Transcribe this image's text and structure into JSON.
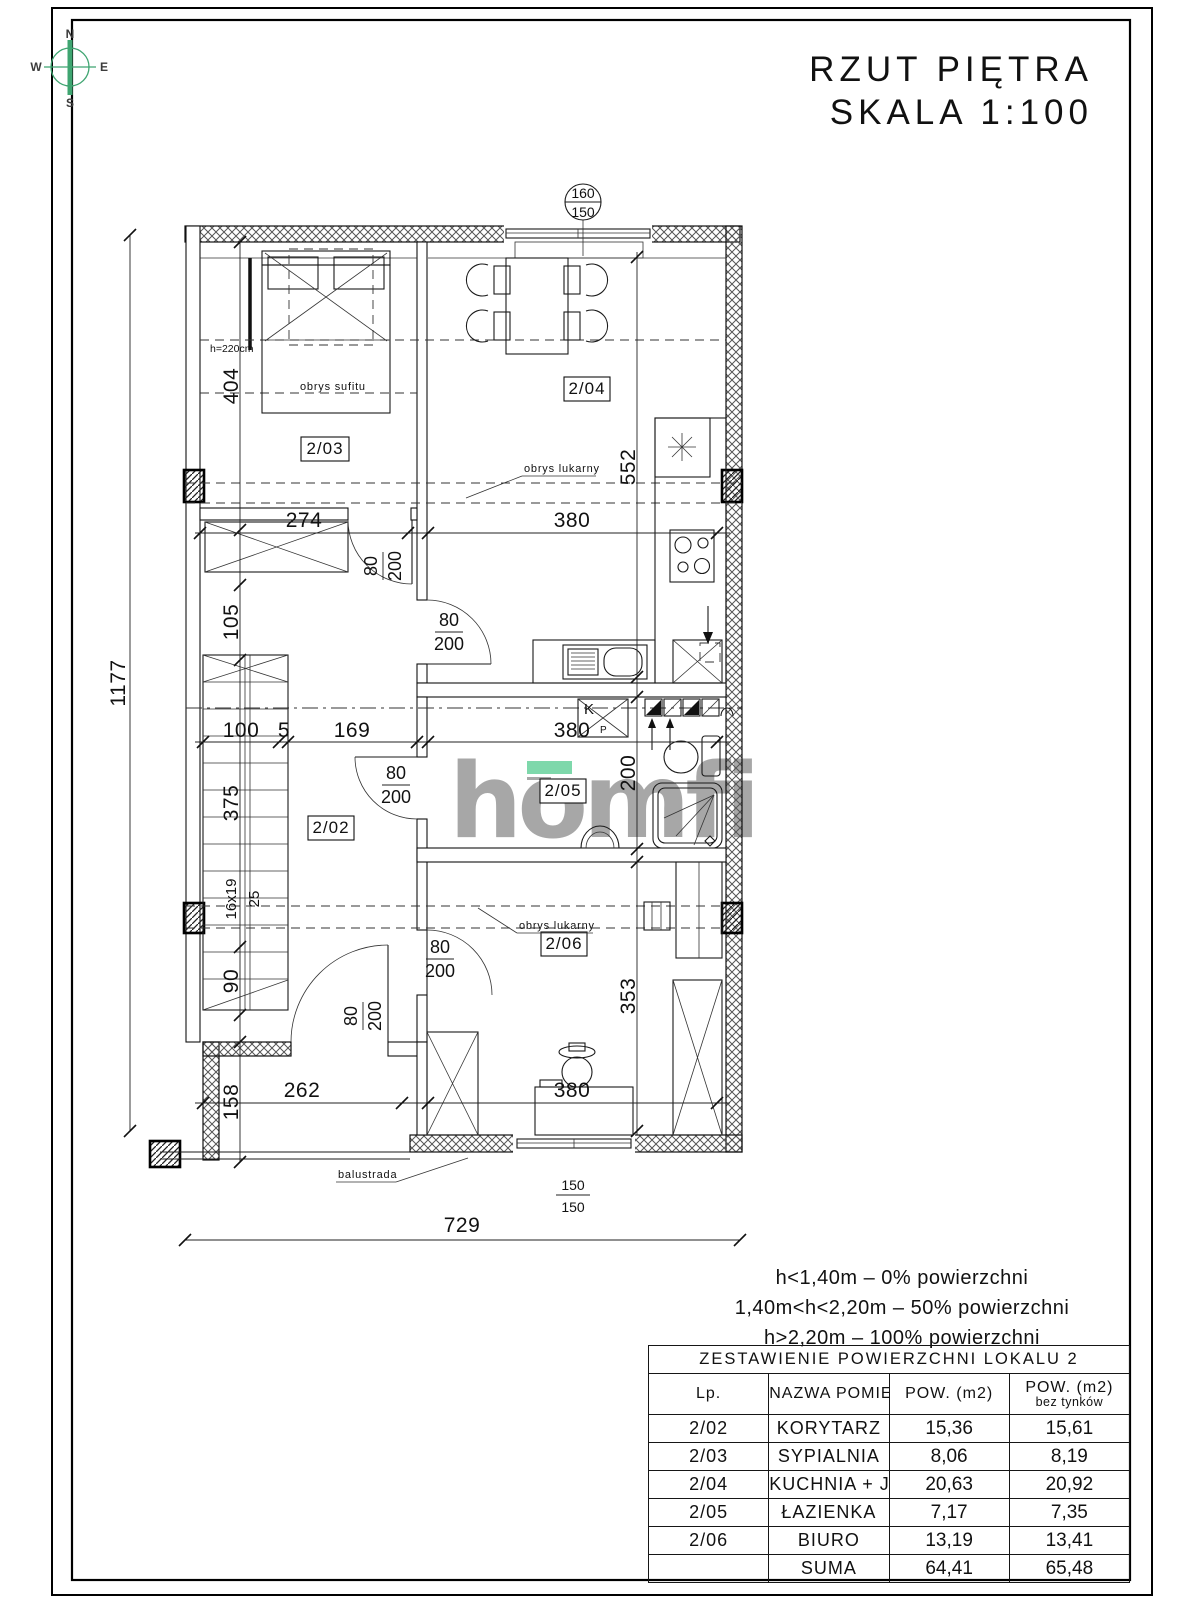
{
  "header": {
    "title_line1": "RZUT PIĘTRA",
    "title_line2": "SKALA 1:100"
  },
  "compass": {
    "n": "N",
    "e": "E",
    "s": "S",
    "w": "W"
  },
  "watermark": {
    "text": "homfi"
  },
  "colors": {
    "accent_green": "#7ed8ab",
    "watermark_gray": "#a7a7a7",
    "compass_green": "#3fa571"
  },
  "plan": {
    "room_labels": {
      "r202": "2/02",
      "r203": "2/03",
      "r204": "2/04",
      "r205": "2/05",
      "r206": "2/06"
    },
    "dims": {
      "overall_v": "1177",
      "overall_h": "729",
      "d404": "404",
      "d105": "105",
      "d375": "375",
      "d90": "90",
      "d158": "158",
      "d274": "274",
      "d380_top": "380",
      "d100": "100",
      "d5": "5",
      "d169": "169",
      "d380_mid": "380",
      "d552": "552",
      "d200": "200",
      "d353": "353",
      "d262": "262",
      "d380_bottom": "380"
    },
    "door_label": {
      "w": "80",
      "h": "200"
    },
    "window_top": {
      "num": "160",
      "den": "150"
    },
    "window_bottom": {
      "num": "150",
      "den": "150"
    },
    "stairs": {
      "note1": "16x19",
      "note2": "25"
    },
    "annotations": {
      "obrys_sufitu": "obrys sufitu",
      "obrys_lukarny": "obrys lukarny",
      "height_note": "h=220cm",
      "balustrade": "balustrada",
      "shaft_k": "K",
      "shaft_p": "P"
    }
  },
  "notes": {
    "line1": "h<1,40m  –  0% powierzchni",
    "line2": "1,40m<h<2,20m  –  50% powierzchni",
    "line3": "h>2,20m  –  100% powierzchni"
  },
  "area_table": {
    "title": "ZESTAWIENIE POWIERZCHNI LOKALU 2",
    "columns": {
      "lp": "Lp.",
      "name": "NAZWA POMIESZCZENIA",
      "area": "POW. (m2)",
      "area_net_1": "POW. (m2)",
      "area_net_2": "bez tynków"
    },
    "rows": [
      {
        "lp": "2/02",
        "name": "KORYTARZ",
        "area": "15,36",
        "area_net": "15,61"
      },
      {
        "lp": "2/03",
        "name": "SYPIALNIA",
        "area": "8,06",
        "area_net": "8,19"
      },
      {
        "lp": "2/04",
        "name": "KUCHNIA + JADANIA",
        "area": "20,63",
        "area_net": "20,92"
      },
      {
        "lp": "2/05",
        "name": "ŁAZIENKA",
        "area": "7,17",
        "area_net": "7,35"
      },
      {
        "lp": "2/06",
        "name": "BIURO",
        "area": "13,19",
        "area_net": "13,41"
      }
    ],
    "total": {
      "label": "SUMA",
      "area": "64,41",
      "area_net": "65,48"
    }
  }
}
